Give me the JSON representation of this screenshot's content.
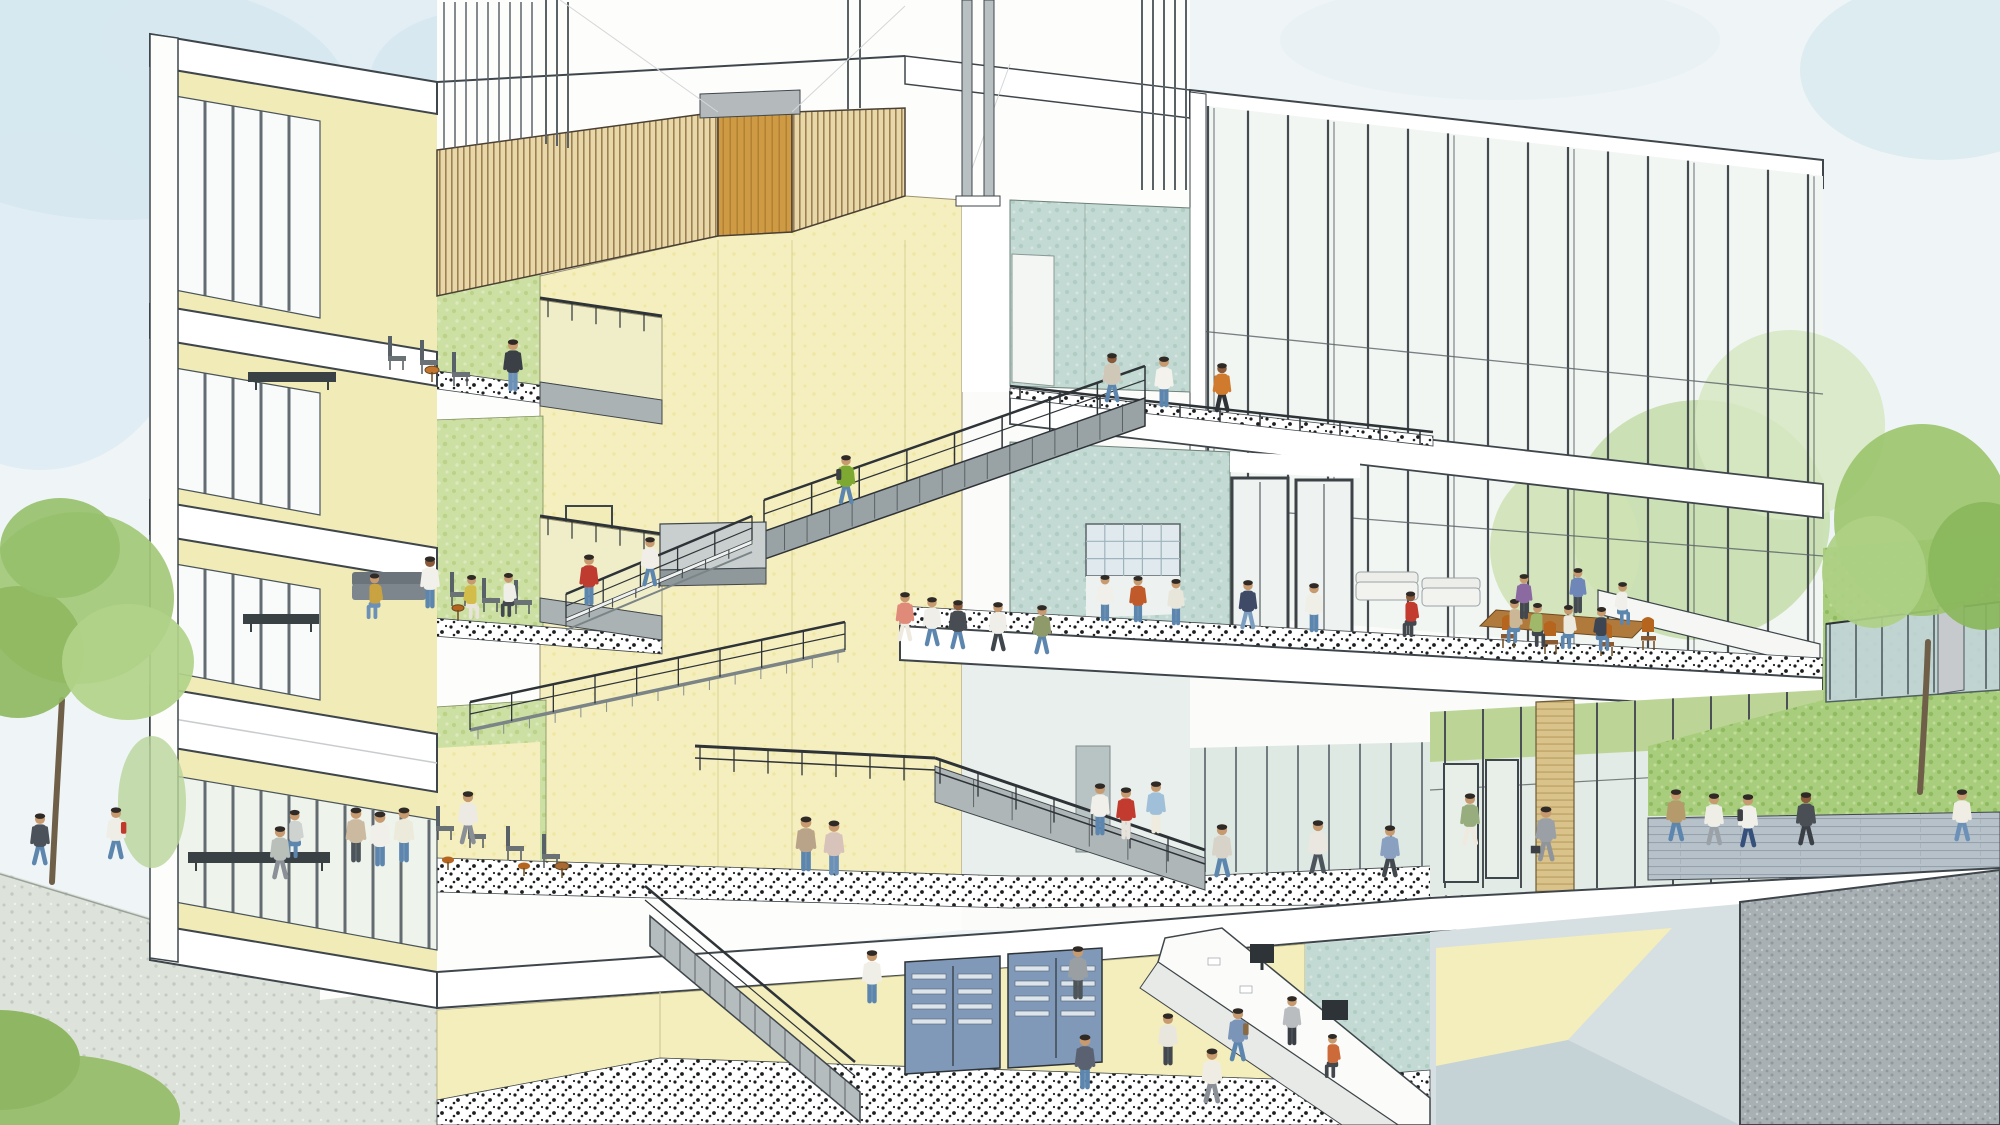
{
  "scene": {
    "label": "Watercolor architectural cross-section of a multi-story campus building: central cream atrium with zigzag stairs, green-walled study lounges on the left, teal lounge with glass curtain wall on the right, basement with mailboxes and service counter, students throughout, trees and lawns outside",
    "type": "architectural-section-illustration",
    "palette": {
      "sky": "#eff5f7",
      "skyPatch": "#cde3ee",
      "cream": "#f5efbf",
      "creamBand": "#f1ebb7",
      "green": "#cde0a4",
      "teal": "#c2dad3",
      "wood": "#e8d8a9",
      "gold": "#cf9a44",
      "grass": "#a7cd7d",
      "concrete": "#a9b0b4",
      "stair": "#99a3a5",
      "rail": "#2e3337",
      "outline": "#3f464b",
      "pave": "#dde2da",
      "brickPath": "#b6c1ca",
      "mailbox": "#8099b9",
      "skin": "#c89a70",
      "skinDark": "#8a5a3b",
      "hair": "#2f2a26",
      "terrazzo": "#ffffff"
    },
    "foliage": [
      {
        "x": 1700,
        "y": 520,
        "rx": 130,
        "ry": 120,
        "f": "#c6dfae",
        "o": 0.9
      },
      {
        "x": 1790,
        "y": 425,
        "rx": 95,
        "ry": 95,
        "f": "#d6e8c2",
        "o": 0.85
      },
      {
        "x": 1565,
        "y": 548,
        "rx": 75,
        "ry": 85,
        "f": "#cfe2b4",
        "o": 0.85
      }
    ],
    "trees": [
      {
        "trunk": "M62,700 C58,770 55,820 52,882",
        "tw": 6,
        "crowns": [
          [
            78,
            598,
            96,
            86,
            "#a3c878"
          ],
          [
            18,
            652,
            66,
            66,
            "#8fb961"
          ],
          [
            128,
            662,
            66,
            58,
            "#b1d289"
          ],
          [
            60,
            548,
            60,
            50,
            "#97c06c"
          ]
        ]
      },
      {
        "trunk": "M1928,642 C1926,700 1923,745 1920,792",
        "tw": 6,
        "crowns": [
          [
            1922,
            520,
            88,
            96,
            "#9cc46e"
          ],
          [
            1984,
            566,
            56,
            64,
            "#8ab75c"
          ],
          [
            1874,
            572,
            52,
            56,
            "#aed084"
          ]
        ]
      }
    ],
    "furniture": [
      {
        "t": "bench",
        "x": 248,
        "y": 372,
        "w": 88,
        "h": 10
      },
      {
        "t": "chair",
        "x": 388,
        "y": 370
      },
      {
        "t": "chair",
        "x": 420,
        "y": 374
      },
      {
        "t": "chair",
        "x": 452,
        "y": 386
      },
      {
        "t": "tableRound",
        "x": 432,
        "y": 382,
        "r": 7,
        "c": "#c4762e"
      },
      {
        "t": "bench",
        "x": 243,
        "y": 614,
        "w": 76,
        "h": 10
      },
      {
        "t": "sofa",
        "x": 352,
        "y": 602,
        "w": 74,
        "h": 24
      },
      {
        "t": "chair",
        "x": 450,
        "y": 606
      },
      {
        "t": "chair",
        "x": 482,
        "y": 612
      },
      {
        "t": "chair",
        "x": 514,
        "y": 614
      },
      {
        "t": "tableRound",
        "x": 458,
        "y": 620,
        "r": 6,
        "c": "#b5651d"
      },
      {
        "t": "bench",
        "x": 188,
        "y": 852,
        "w": 142,
        "h": 11
      },
      {
        "t": "chair",
        "x": 436,
        "y": 840
      },
      {
        "t": "chair",
        "x": 468,
        "y": 848
      },
      {
        "t": "chair",
        "x": 506,
        "y": 860
      },
      {
        "t": "chair",
        "x": 542,
        "y": 868
      },
      {
        "t": "stool",
        "x": 448,
        "y": 870
      },
      {
        "t": "stool",
        "x": 524,
        "y": 876
      },
      {
        "t": "tableRound",
        "x": 562,
        "y": 878,
        "r": 7,
        "c": "#a86a32"
      },
      {
        "t": "couch",
        "x": 1356,
        "y": 602,
        "w": 62,
        "h": 34
      },
      {
        "t": "couch",
        "x": 1422,
        "y": 608,
        "w": 58,
        "h": 32
      },
      {
        "t": "tableWood",
        "pts": "1496,610 1648,622 1632,638 1480,626"
      },
      {
        "t": "chairO",
        "x": 1502,
        "y": 648
      },
      {
        "t": "chairO",
        "x": 1544,
        "y": 654
      },
      {
        "t": "chairO",
        "x": 1600,
        "y": 656
      },
      {
        "t": "chairO",
        "x": 1642,
        "y": 650
      }
    ],
    "people": [
      {
        "x": 513,
        "y": 390,
        "s": 0.9,
        "pose": "stand",
        "dir": 1,
        "top": "#3b4046",
        "bot": "#6b91b8"
      },
      {
        "x": 372,
        "y": 618,
        "s": 0.85,
        "pose": "sit",
        "dir": -1,
        "top": "#c9a342",
        "bot": "#6b91b8"
      },
      {
        "x": 430,
        "y": 607,
        "s": 0.9,
        "pose": "stand",
        "dir": 1,
        "top": "#f2f0ea",
        "bot": "#5d86ae",
        "skin": "#8a5a3b"
      },
      {
        "x": 474,
        "y": 618,
        "s": 0.82,
        "pose": "sit",
        "dir": 1,
        "top": "#d3bd4a",
        "bot": "#e9e4da"
      },
      {
        "x": 506,
        "y": 616,
        "s": 0.82,
        "pose": "sit",
        "dir": -1,
        "top": "#efefe8",
        "bot": "#42484e"
      },
      {
        "x": 589,
        "y": 604,
        "s": 0.88,
        "pose": "stand",
        "dir": -1,
        "top": "#bf3b2f",
        "bot": "#5d86ae"
      },
      {
        "x": 292,
        "y": 857,
        "s": 0.9,
        "pose": "sit",
        "dir": -1,
        "top": "#cfd3cf",
        "bot": "#5d86ae"
      },
      {
        "x": 356,
        "y": 861,
        "s": 0.95,
        "pose": "stand",
        "dir": 1,
        "top": "#cbb9a0",
        "bot": "#4d555c"
      },
      {
        "x": 380,
        "y": 865,
        "s": 0.95,
        "pose": "stand",
        "dir": -1,
        "top": "#f1efe9",
        "bot": "#5d86ae"
      },
      {
        "x": 404,
        "y": 861,
        "s": 0.95,
        "pose": "stand",
        "dir": 1,
        "top": "#eceada",
        "bot": "#5d86ae"
      },
      {
        "x": 846,
        "y": 503,
        "s": 0.85,
        "pose": "walk",
        "dir": -1,
        "top": "#7da832",
        "bot": "#5d86ae",
        "bag": "#3c4044"
      },
      {
        "x": 650,
        "y": 585,
        "s": 0.85,
        "pose": "walk",
        "dir": 1,
        "top": "#f0eee6",
        "bot": "#5d86ae"
      },
      {
        "x": 1112,
        "y": 401,
        "s": 0.85,
        "pose": "walk",
        "dir": -1,
        "top": "#cfc8b8",
        "bot": "#5d86ae",
        "skin": "#8a5a3b"
      },
      {
        "x": 1164,
        "y": 406,
        "s": 0.88,
        "pose": "stand",
        "dir": -1,
        "top": "#f4f2ec",
        "bot": "#5d86ae"
      },
      {
        "x": 1222,
        "y": 411,
        "s": 0.85,
        "pose": "walk",
        "dir": -1,
        "top": "#d07a2e",
        "bot": "#2f3338",
        "skin": "#8a5a3b"
      },
      {
        "x": 905,
        "y": 640,
        "s": 0.85,
        "pose": "walk",
        "dir": 1,
        "top": "#e08a7a",
        "bot": "#efeadf"
      },
      {
        "x": 932,
        "y": 645,
        "s": 0.85,
        "pose": "walk",
        "dir": -1,
        "top": "#f0eee8",
        "bot": "#5d86ae"
      },
      {
        "x": 958,
        "y": 648,
        "s": 0.85,
        "pose": "walk",
        "dir": 1,
        "top": "#474d52",
        "bot": "#5d86ae",
        "skin": "#8a5a3b"
      },
      {
        "x": 998,
        "y": 650,
        "s": 0.85,
        "pose": "walk",
        "dir": -1,
        "top": "#efeee8",
        "bot": "#3f464c"
      },
      {
        "x": 1042,
        "y": 653,
        "s": 0.85,
        "pose": "walk",
        "dir": 1,
        "top": "#8f9a6a",
        "bot": "#5d86ae"
      },
      {
        "x": 1105,
        "y": 620,
        "s": 0.8,
        "pose": "stand",
        "dir": 1,
        "top": "#f1efe9",
        "bot": "#5d86ae"
      },
      {
        "x": 1138,
        "y": 621,
        "s": 0.8,
        "pose": "stand",
        "dir": -1,
        "top": "#c05a2a",
        "bot": "#5d86ae"
      },
      {
        "x": 1176,
        "y": 624,
        "s": 0.8,
        "pose": "stand",
        "dir": 1,
        "top": "#e8e6da",
        "bot": "#5d86ae"
      },
      {
        "x": 1248,
        "y": 628,
        "s": 0.85,
        "pose": "walk",
        "dir": 1,
        "top": "#3e4a66",
        "bot": "#7b9ec0"
      },
      {
        "x": 1314,
        "y": 631,
        "s": 0.85,
        "pose": "stand",
        "dir": -1,
        "top": "#f0efe7",
        "bot": "#5d86ae"
      },
      {
        "x": 1408,
        "y": 636,
        "s": 0.85,
        "pose": "sit",
        "dir": -1,
        "top": "#c23b2e",
        "bot": "#42484e",
        "skin": "#8a5a3b"
      },
      {
        "x": 1512,
        "y": 642,
        "s": 0.82,
        "pose": "sit",
        "dir": -1,
        "top": "#cbb695",
        "bot": "#5d86ae"
      },
      {
        "x": 1540,
        "y": 646,
        "s": 0.82,
        "pose": "sit",
        "dir": 1,
        "top": "#9fb86a",
        "bot": "#3f464c"
      },
      {
        "x": 1566,
        "y": 648,
        "s": 0.82,
        "pose": "sit",
        "dir": -1,
        "top": "#eceade",
        "bot": "#5d86ae"
      },
      {
        "x": 1604,
        "y": 650,
        "s": 0.82,
        "pose": "sit",
        "dir": 1,
        "top": "#3e4552",
        "bot": "#5d86ae"
      },
      {
        "x": 1524,
        "y": 618,
        "s": 0.78,
        "pose": "stand",
        "dir": -1,
        "top": "#8a6aa0",
        "bot": "#42484e"
      },
      {
        "x": 1578,
        "y": 612,
        "s": 0.78,
        "pose": "stand",
        "dir": -1,
        "top": "#6e87b8",
        "bot": "#454b50"
      },
      {
        "x": 1625,
        "y": 624,
        "s": 0.8,
        "pose": "sit",
        "dir": 1,
        "top": "#f0efe9",
        "bot": "#5d86ae"
      },
      {
        "x": 806,
        "y": 870,
        "s": 0.95,
        "pose": "stand",
        "dir": 1,
        "top": "#b9a489",
        "bot": "#5d86ae"
      },
      {
        "x": 834,
        "y": 874,
        "s": 0.95,
        "pose": "stand",
        "dir": -1,
        "top": "#d8c3bb",
        "bot": "#6b91b8"
      },
      {
        "x": 1100,
        "y": 834,
        "s": 0.9,
        "pose": "stand",
        "dir": 1,
        "top": "#f0efe9",
        "bot": "#5d86ae"
      },
      {
        "x": 1126,
        "y": 838,
        "s": 0.9,
        "pose": "stand",
        "dir": -1,
        "top": "#c23b2e",
        "bot": "#e8e4dc"
      },
      {
        "x": 1156,
        "y": 832,
        "s": 0.9,
        "pose": "stand",
        "dir": 1,
        "top": "#9fc0d8",
        "bot": "#efecdf"
      },
      {
        "x": 468,
        "y": 843,
        "s": 0.92,
        "pose": "walk",
        "dir": 1,
        "top": "#eceae2",
        "bot": "#8a9096"
      },
      {
        "x": 1222,
        "y": 876,
        "s": 0.92,
        "pose": "walk",
        "dir": -1,
        "top": "#d8d3c8",
        "bot": "#5d86ae"
      },
      {
        "x": 1318,
        "y": 872,
        "s": 0.92,
        "pose": "walk",
        "dir": 1,
        "top": "#e9e7df",
        "bot": "#4d555c"
      },
      {
        "x": 1390,
        "y": 876,
        "s": 0.9,
        "pose": "walk",
        "dir": 1,
        "top": "#8aa0c0",
        "bot": "#42484e"
      },
      {
        "x": 1546,
        "y": 860,
        "s": 0.95,
        "pose": "walk",
        "dir": -1,
        "top": "#9aa0a6",
        "bot": "#8f959b",
        "case": true
      },
      {
        "x": 1470,
        "y": 844,
        "s": 0.9,
        "pose": "walk",
        "dir": -1,
        "top": "#97ad7e",
        "bot": "#efeadf"
      },
      {
        "x": 1676,
        "y": 840,
        "s": 0.9,
        "pose": "walk",
        "dir": -1,
        "top": "#b59a6c",
        "bot": "#5d86ae"
      },
      {
        "x": 1714,
        "y": 844,
        "s": 0.9,
        "pose": "walk",
        "dir": -1,
        "top": "#efeee6",
        "bot": "#9aa2a8"
      },
      {
        "x": 1748,
        "y": 846,
        "s": 0.92,
        "pose": "walk",
        "dir": -1,
        "top": "#f1efe9",
        "bot": "#35507a",
        "bag": "#3c4044"
      },
      {
        "x": 1806,
        "y": 844,
        "s": 0.92,
        "pose": "walk",
        "dir": -1,
        "top": "#4a4e55",
        "bot": "#3b3f46",
        "skin": "#8a5a3b"
      },
      {
        "x": 1962,
        "y": 840,
        "s": 0.9,
        "pose": "walk",
        "dir": -1,
        "top": "#efede4",
        "bot": "#6b91b8"
      },
      {
        "x": 40,
        "y": 864,
        "s": 0.9,
        "pose": "walk",
        "dir": 1,
        "top": "#4c525a",
        "bot": "#5d86ae"
      },
      {
        "x": 116,
        "y": 858,
        "s": 0.9,
        "pose": "walk",
        "dir": 1,
        "top": "#efeee6",
        "bot": "#5d86ae",
        "bag": "#c0392b"
      },
      {
        "x": 280,
        "y": 878,
        "s": 0.92,
        "pose": "walk",
        "dir": -1,
        "top": "#b9bfb9",
        "bot": "#8a9096"
      },
      {
        "x": 872,
        "y": 1002,
        "s": 0.92,
        "pose": "stand",
        "dir": 1,
        "top": "#f0efe7",
        "bot": "#5d86ae"
      },
      {
        "x": 1078,
        "y": 998,
        "s": 0.92,
        "pose": "stand",
        "dir": 1,
        "top": "#9a9fa3",
        "bot": "#4d545a"
      },
      {
        "x": 1085,
        "y": 1088,
        "s": 0.95,
        "pose": "stand",
        "dir": 1,
        "top": "#5a6170",
        "bot": "#5d86ae"
      },
      {
        "x": 1238,
        "y": 1060,
        "s": 0.92,
        "pose": "walk",
        "dir": 1,
        "top": "#7b95b8",
        "bot": "#5d86ae",
        "bag": "#8a6a42"
      },
      {
        "x": 1212,
        "y": 1102,
        "s": 0.95,
        "pose": "walk",
        "dir": 1,
        "top": "#efede3",
        "bot": "#8a9096"
      },
      {
        "x": 1292,
        "y": 1044,
        "s": 0.85,
        "pose": "stand",
        "dir": -1,
        "top": "#b9bdbf",
        "bot": "#3a3f45"
      },
      {
        "x": 1330,
        "y": 1077,
        "s": 0.82,
        "pose": "sit",
        "dir": -1,
        "top": "#cd6a3a",
        "bot": "#42484e"
      },
      {
        "x": 1168,
        "y": 1064,
        "s": 0.9,
        "pose": "stand",
        "dir": -1,
        "top": "#e9e7dd",
        "bot": "#42484e"
      }
    ]
  }
}
